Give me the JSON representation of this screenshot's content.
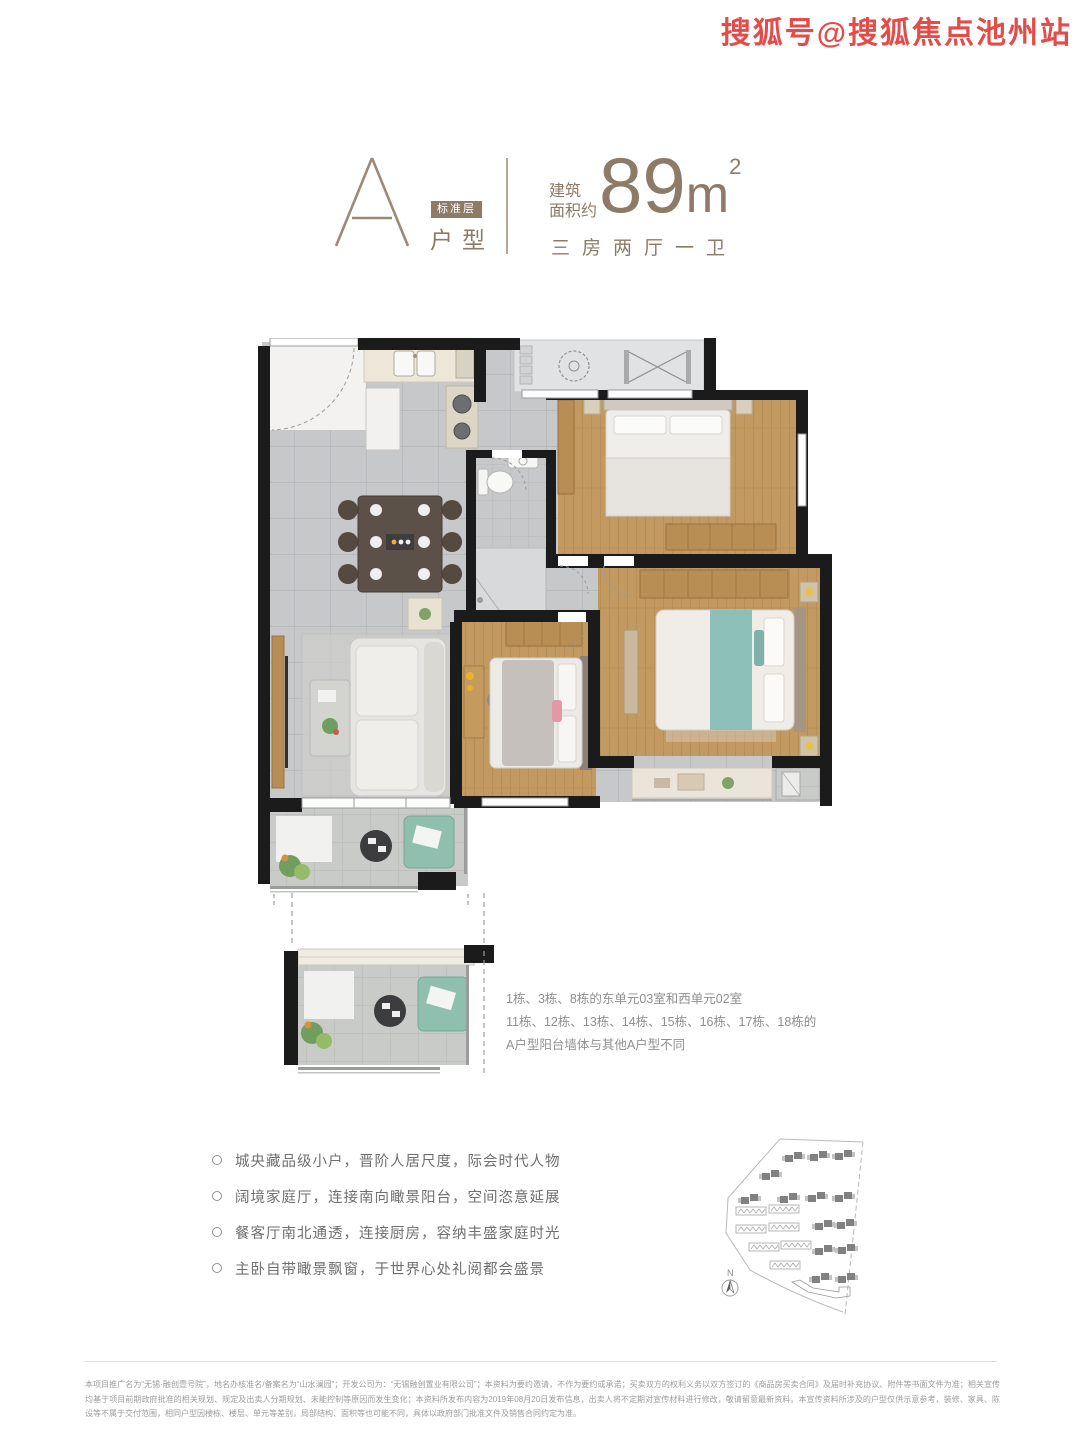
{
  "watermark": {
    "text": "搜狐号@搜狐焦点池州站",
    "color": "#e23d3a"
  },
  "header": {
    "plan_letter": "A",
    "floor_badge": "标准层",
    "unit_type_label": "户型",
    "area_label_line1": "建筑",
    "area_label_line2": "面积约",
    "area_value": "89",
    "area_unit": "m",
    "area_exponent": "2",
    "layout_summary": "三房两厅一卫",
    "accent_color": "#8d7b68"
  },
  "floor_plan": {
    "notes": [
      "1栋、3栋、8栋的东单元03室和西单元02室",
      "11栋、12栋、13栋、14栋、15栋、16栋、17栋、18栋的",
      "A户型阳台墙体与其他A户型不同"
    ]
  },
  "selling_points": [
    "城央藏品级小户，晋阶人居尺度，际会时代人物",
    "阔境家庭厅，连接南向瞰景阳台，空间恣意延展",
    "餐客厅南北通透，连接厨房，容纳丰盛家庭时光",
    "主卧自带瞰景飘窗，于世界心处礼阅都会盛景"
  ],
  "site_plan": {
    "north_label": "N"
  },
  "disclaimer": "本项目推广名为“无锡·融创壹号院”，地名办核准名/备案名为“山水澜园”；开发公司为：“无锡融创置业有限公司”；本资料为要约邀请，不作为要约或承诺；买卖双方的权利义务以双方签订的《商品房买卖合同》及届时补充协议、附件等书面文件为准；相关宣传均基于项目前期政府批准的相关规划、规定及出卖人分期规划、未能控制等原因而发生变化；本资料所发布内容为2019年08月20日发布信息，出卖人将不定期对宣传材料进行修改，敬请留意最新资料。本宣传资料所涉及的户型仅供示意参考，装修、家具、陈设等不属于交付范围，相同户型因楼栋、楼层、单元等差别，局部结构、面积等也可能不同，具体以政府部门批准文件及销售合同约定为准。",
  "colors": {
    "accent_taupe": "#8d7b68",
    "watermark_red": "#e23d3a",
    "wall_black": "#1b1b1b",
    "tile_gray": "#c7c8ca",
    "wood_floor": "#c29a61",
    "balcony_chair_green": "#8fbfae",
    "master_bed_teal": "#8cc0b9",
    "note_gray": "#8f8f8f",
    "disclaimer_gray": "#9c9c9c"
  }
}
